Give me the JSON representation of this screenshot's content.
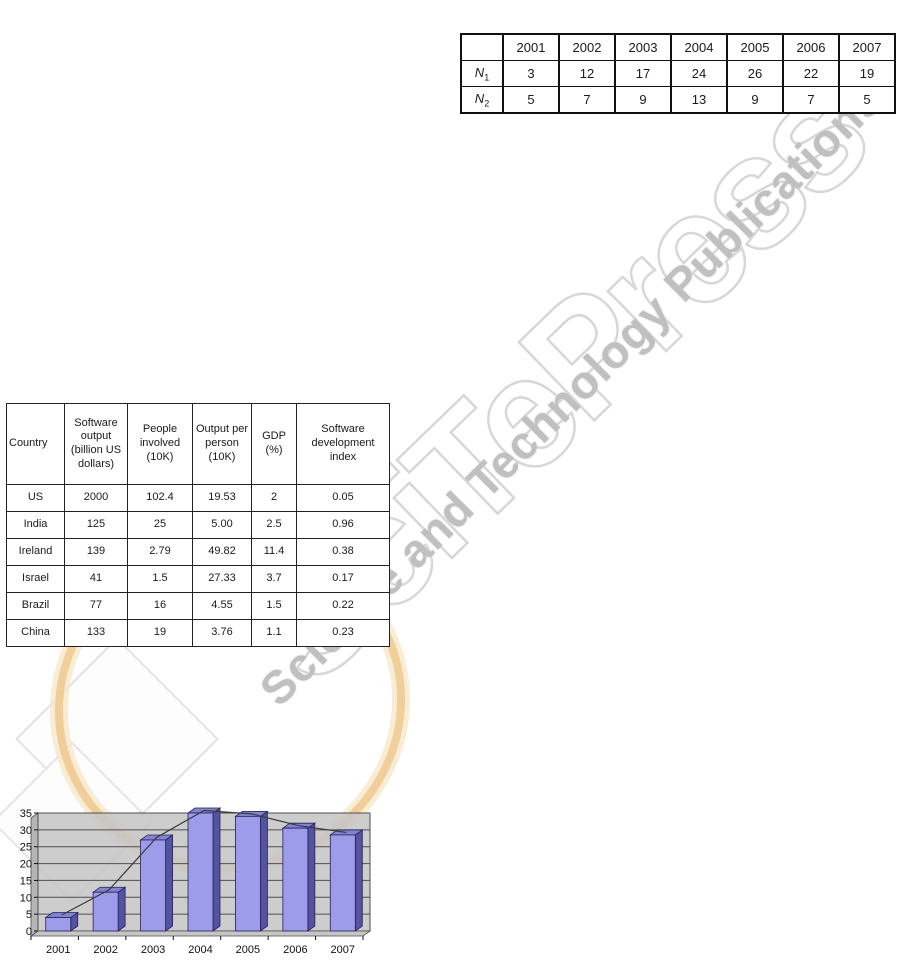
{
  "watermark": {
    "brand_text": "SciTePress",
    "tagline_text": "Science and Technology Publications",
    "outline_color": "#d7d7d7",
    "tagline_color": "#c0c0c0",
    "swoosh_outer_color": "#f7e3c0",
    "swoosh_inner_color": "#eec98f"
  },
  "years_table": {
    "columns": [
      "",
      "2001",
      "2002",
      "2003",
      "2004",
      "2005",
      "2006",
      "2007"
    ],
    "rows": [
      {
        "label_main": "N",
        "label_sub": "1",
        "values": [
          "3",
          "12",
          "17",
          "24",
          "26",
          "22",
          "19"
        ]
      },
      {
        "label_main": "N",
        "label_sub": "2",
        "values": [
          "5",
          "7",
          "9",
          "13",
          "9",
          "7",
          "5"
        ]
      }
    ]
  },
  "country_table": {
    "columns": [
      "Country",
      "Software output (billion US dollars)",
      "People involved (10K)",
      "Output per person (10K)",
      "GDP (%)",
      "Software development index"
    ],
    "col_widths": [
      58,
      63,
      65,
      59,
      45,
      93
    ],
    "rows": [
      [
        "US",
        "2000",
        "102.4",
        "19.53",
        "2",
        "0.05"
      ],
      [
        "India",
        "125",
        "25",
        "5.00",
        "2.5",
        "0.96"
      ],
      [
        "Ireland",
        "139",
        "2.79",
        "49.82",
        "11.4",
        "0.38"
      ],
      [
        "Israel",
        "41",
        "1.5",
        "27.33",
        "3.7",
        "0.17"
      ],
      [
        "Brazil",
        "77",
        "16",
        "4.55",
        "1.5",
        "0.22"
      ],
      [
        "China",
        "133",
        "19",
        "3.76",
        "1.1",
        "0.23"
      ]
    ]
  },
  "chart_data": {
    "type": "bar",
    "categories": [
      "2001",
      "2002",
      "2003",
      "2004",
      "2005",
      "2006",
      "2007"
    ],
    "series": [
      {
        "name": "value-bars",
        "values": [
          4,
          11.5,
          27,
          35,
          34,
          30.5,
          28.5
        ]
      }
    ],
    "line_overlay": true,
    "title": "",
    "xlabel": "",
    "ylabel": "",
    "ylim": [
      0,
      35
    ],
    "ytick_step": 5,
    "yticks": [
      "0",
      "5",
      "10",
      "15",
      "20",
      "25",
      "30",
      "35"
    ],
    "grid": true,
    "legend": "none",
    "plot_bg_color": "#c6c6c6",
    "wall_side_color": "#b5b5b5",
    "grid_color": "#4f4f4f",
    "bar_front_color": "#9c9cea",
    "bar_side_color": "#53539f",
    "bar_top_color": "#8383d2",
    "bar_outline_color": "#22225a",
    "line_color": "#3a3a3a",
    "axis_text_color": "#111111"
  }
}
